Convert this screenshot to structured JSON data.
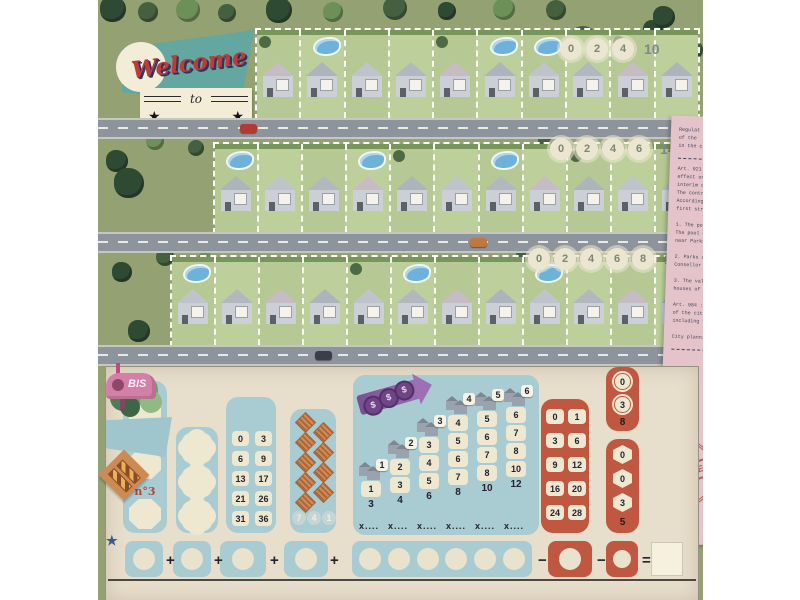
{
  "logo": {
    "welcome": "Welcome",
    "to": "to",
    "stars": "★"
  },
  "streets": [
    {
      "name": "street-1",
      "house_count": 10,
      "park_values": [
        "0",
        "2",
        "4"
      ],
      "park_total": "10",
      "pool_houses": [
        2,
        6,
        7
      ]
    },
    {
      "name": "street-2",
      "house_count": 11,
      "park_values": [
        "0",
        "2",
        "4",
        "6"
      ],
      "park_total": "14",
      "pool_houses": [
        1,
        4,
        7
      ]
    },
    {
      "name": "street-3",
      "house_count": 12,
      "park_values": [
        "0",
        "2",
        "4",
        "6",
        "8"
      ],
      "park_total": "18",
      "pool_houses": [
        1,
        6,
        9
      ]
    }
  ],
  "document": {
    "paragraphs": [
      [
        "Regulat",
        "of the ",
        "in the c"
      ],
      [
        "Art. 921",
        "effect on",
        "interim o",
        "The contr",
        "According",
        "first stre"
      ],
      [
        "1. The pool",
        "The pool o",
        "near Parks"
      ],
      [
        "2. Parks an",
        "Consellor K"
      ],
      [
        "3. The value",
        "houses of th"
      ],
      [
        "Art. 984 : th",
        "of the city",
        "including th"
      ],
      [
        "City plannin"
      ]
    ],
    "stamp": {
      "main": "APPROVED",
      "arc_top": "URBAN",
      "arc_bottom": "PLAN"
    }
  },
  "scoreboard": {
    "plans": {
      "items": [
        "n°1",
        "n°2",
        "n°3"
      ]
    },
    "pools": {
      "rows": [
        [
          "0",
          "3"
        ],
        [
          "6",
          "9"
        ],
        [
          "13",
          "17"
        ],
        [
          "21",
          "26"
        ],
        [
          "31",
          "36"
        ]
      ]
    },
    "temp_agency": {
      "diamond_count": 9,
      "bonus": [
        "7",
        "4",
        "1"
      ]
    },
    "estate": {
      "multiplier_label": "x....",
      "columns": [
        {
          "size": "1",
          "boxes": [
            "1"
          ],
          "max": "3"
        },
        {
          "size": "2",
          "boxes": [
            "2",
            "3"
          ],
          "max": "4"
        },
        {
          "size": "3",
          "boxes": [
            "3",
            "4",
            "5"
          ],
          "max": "6"
        },
        {
          "size": "4",
          "boxes": [
            "4",
            "5",
            "6",
            "7"
          ],
          "max": "8"
        },
        {
          "size": "5",
          "boxes": [
            "5",
            "6",
            "7",
            "8"
          ],
          "max": "10"
        },
        {
          "size": "6",
          "boxes": [
            "6",
            "7",
            "8",
            "10"
          ],
          "max": "12"
        }
      ]
    },
    "bis": {
      "label": "BIS",
      "rows": [
        [
          "0",
          "1"
        ],
        [
          "3",
          "6"
        ],
        [
          "9",
          "12"
        ],
        [
          "16",
          "20"
        ],
        [
          "24",
          "28"
        ]
      ]
    },
    "roundabout": {
      "star": "★",
      "slots": [
        "0",
        "3"
      ],
      "max": "8"
    },
    "refusal": {
      "slots": [
        "0",
        "0",
        "3"
      ],
      "max": "5"
    },
    "formula": {
      "plus": "+",
      "minus": "−",
      "equals": "="
    }
  },
  "colors": {
    "grass": "#94a273",
    "teal_banner": "#63a7a0",
    "script_red": "#c23a33",
    "panel_blue": "#a9ccd2",
    "terracotta": "#bf5741",
    "cream": "#efe8d1",
    "purple": "#8f62a4",
    "orange": "#cd8a52",
    "doc_pink": "#e5c3ca",
    "bis_pink": "#d47fa8",
    "parchment": "#e7decb",
    "pool_blue": "#6fb2d9",
    "star_blue": "#3a5a8c"
  }
}
